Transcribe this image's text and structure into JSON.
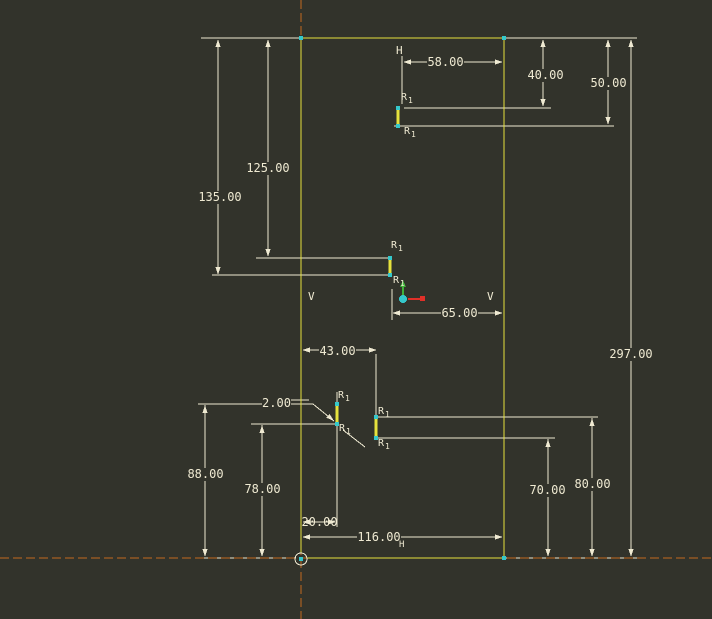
{
  "app": {
    "description": "CAD 2D sketcher viewport with dimensioned rectangular profile sketch",
    "background": "#32332b"
  },
  "colors": {
    "geometry": "#e5e23d",
    "annotation": "#efead2",
    "centerline": "#c2691f",
    "vertex": "#35c8cb",
    "axis_x": "#e03028",
    "axis_y": "#3fb03a"
  },
  "dims": {
    "d58": "58.00",
    "d40": "40.00",
    "d50": "50.00",
    "d125": "125.00",
    "d135": "135.00",
    "d65": "65.00",
    "d297": "297.00",
    "d43": "43.00",
    "d2": "2.00",
    "d88": "88.00",
    "d78": "78.00",
    "d20": "20.00",
    "d116": "116.00",
    "d116_suffix": "H",
    "d70": "70.00",
    "d80": "80.00"
  },
  "constraints": {
    "horizontal": "H",
    "vertical": "V"
  },
  "radius": {
    "letter": "R",
    "subscript": "1"
  },
  "sketch": {
    "dimension_values": [
      58,
      40,
      50,
      125,
      135,
      65,
      297,
      43,
      2,
      88,
      78,
      20,
      116,
      70,
      80
    ],
    "fillet_radius_label_count": 8,
    "entities": {
      "outer_rect_px": [
        301,
        38,
        504,
        558
      ],
      "notch_segments_px": [
        [
          398,
          108,
          126
        ],
        [
          390,
          258,
          275
        ],
        [
          337,
          404,
          424
        ],
        [
          376,
          417,
          438
        ]
      ],
      "origin_px": [
        301,
        559
      ],
      "csys_px": [
        403,
        299
      ]
    }
  }
}
